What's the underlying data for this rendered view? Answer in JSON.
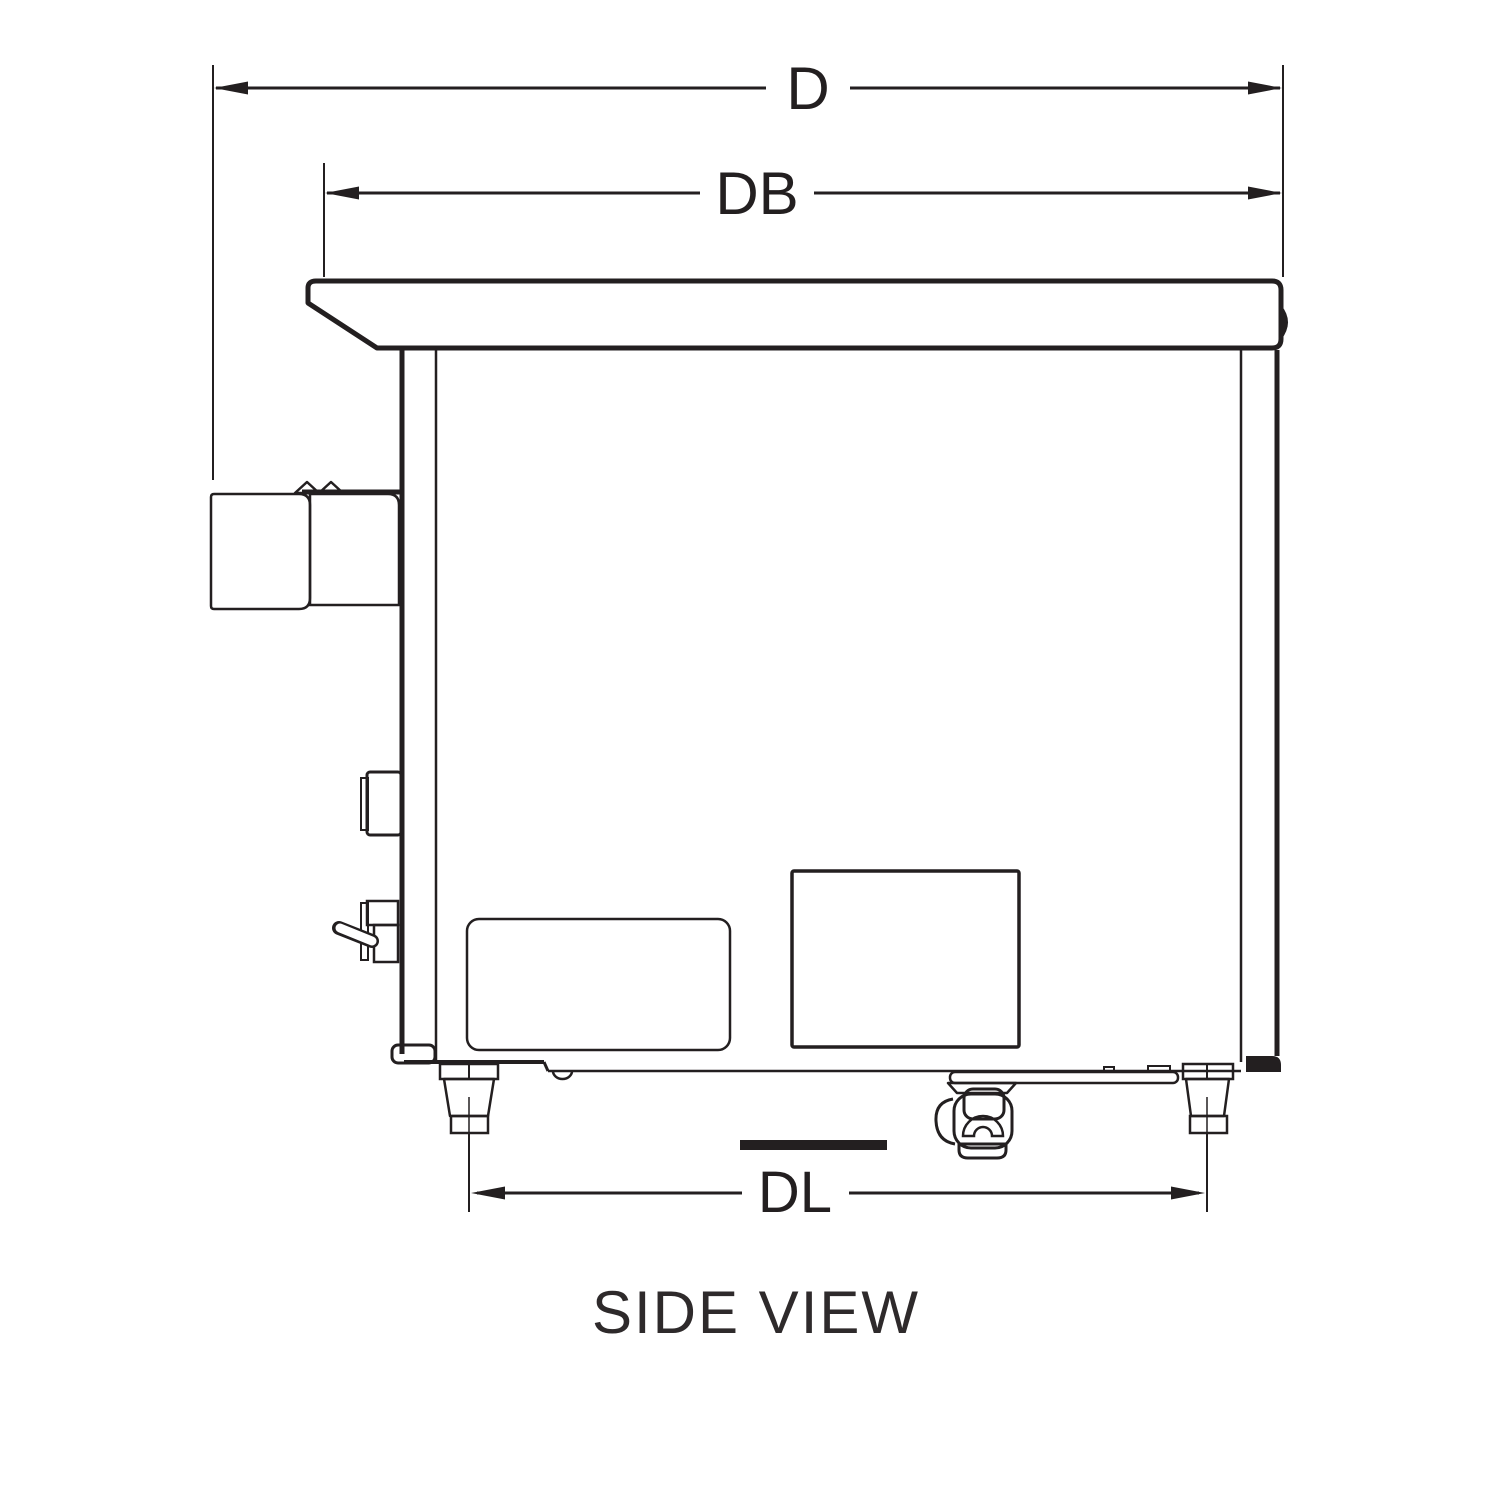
{
  "diagram": {
    "title": "SIDE VIEW",
    "dimensions": {
      "overall_depth": {
        "label": "D"
      },
      "body_depth": {
        "label": "DB"
      },
      "leg_depth": {
        "label": "DL"
      }
    },
    "colors": {
      "line": "#231f20",
      "background": "#ffffff",
      "label_background": "#ffffff",
      "caption_text": "#2e2a2b"
    }
  }
}
